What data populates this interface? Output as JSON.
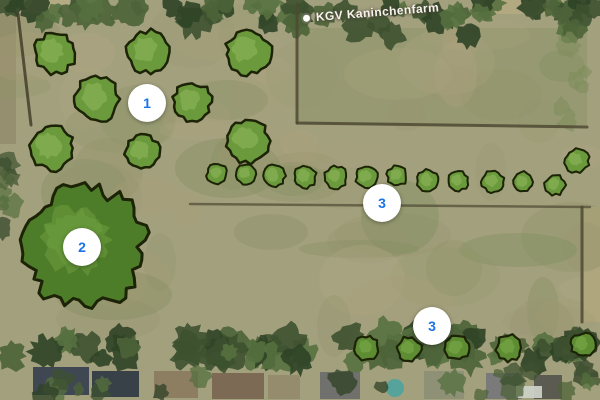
{
  "map": {
    "place_label": {
      "text": "KGV Kaninchenfarm"
    },
    "markers": [
      {
        "label": "1",
        "x": 147,
        "y": 103
      },
      {
        "label": "2",
        "x": 82,
        "y": 247
      },
      {
        "label": "3",
        "x": 382,
        "y": 203
      },
      {
        "label": "3",
        "x": 432,
        "y": 326
      }
    ],
    "colors": {
      "marker_bg": "#ffffff",
      "marker_text": "#1a73e8",
      "label_text": "#f6f3ec",
      "field_base": "#a3a07e",
      "subfield_green": "#8c9165",
      "tree_fill": "#6b9a3c",
      "tree_highlight": "#85af52",
      "big_tree_fill": "#4e7d29",
      "big_tree_highlight": "#649238",
      "tree_outline": "#1c2306",
      "hedge_dark": "#3d5130",
      "boundary_line": "#4f4a33"
    },
    "trees": {
      "large": [
        [
          55,
          53,
          20
        ],
        [
          148,
          52,
          21
        ],
        [
          248,
          52,
          22
        ],
        [
          97,
          99,
          22
        ],
        [
          192,
          102,
          19
        ],
        [
          52,
          148,
          22
        ],
        [
          142,
          152,
          17
        ],
        [
          248,
          141,
          21
        ]
      ],
      "big": [
        85,
        247,
        59
      ],
      "mid_row": [
        [
          217,
          174,
          10
        ],
        [
          246,
          174,
          10
        ],
        [
          274,
          176,
          11
        ],
        [
          305,
          177,
          11
        ],
        [
          336,
          177,
          11
        ],
        [
          367,
          177,
          11
        ],
        [
          397,
          176,
          10
        ],
        [
          428,
          181,
          11
        ],
        [
          458,
          181,
          10
        ],
        [
          493,
          182,
          11
        ],
        [
          523,
          182,
          10
        ],
        [
          555,
          185,
          10
        ],
        [
          577,
          161,
          12
        ]
      ],
      "bottom_row": [
        [
          367,
          348,
          12
        ],
        [
          409,
          349,
          12
        ],
        [
          457,
          348,
          12
        ],
        [
          509,
          348,
          13
        ],
        [
          583,
          345,
          12
        ]
      ]
    },
    "boundaries": [
      [
        297,
        4,
        297,
        123
      ],
      [
        297,
        123,
        587,
        127
      ],
      [
        190,
        204,
        590,
        207
      ],
      [
        582,
        207,
        582,
        322
      ],
      [
        18,
        14,
        31,
        125
      ]
    ],
    "buildings": [
      [
        33,
        367,
        56,
        28,
        "#3a4350"
      ],
      [
        92,
        371,
        47,
        26,
        "#333b46"
      ],
      [
        154,
        371,
        44,
        27,
        "#8c7b60"
      ],
      [
        212,
        373,
        52,
        26,
        "#7b6753"
      ],
      [
        268,
        375,
        32,
        24,
        "#958a6d"
      ],
      [
        320,
        372,
        40,
        27,
        "#6e6e6c"
      ],
      [
        424,
        371,
        40,
        28,
        "#8e9077"
      ],
      [
        486,
        373,
        36,
        26,
        "#78787a"
      ],
      [
        534,
        375,
        28,
        24,
        "#57574f"
      ],
      [
        516,
        386,
        26,
        12,
        "#ccd0c6"
      ]
    ],
    "pool": {
      "x": 395,
      "y": 388,
      "r": 9,
      "color": "#55a39b"
    }
  }
}
